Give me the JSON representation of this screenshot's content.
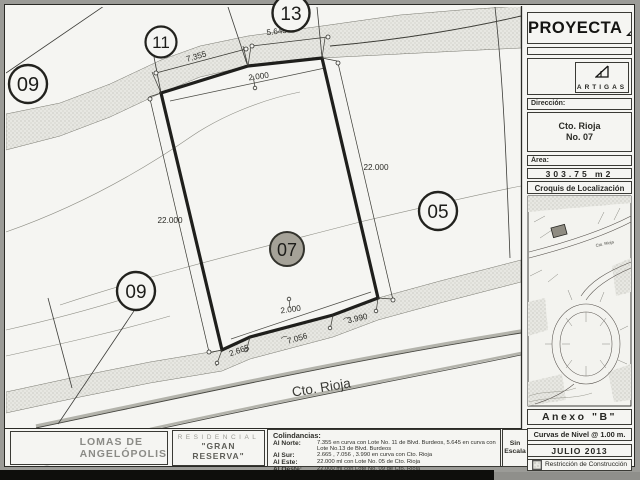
{
  "colors": {
    "paper": "#f5f5f2",
    "ink": "#262622",
    "road_band": "#e7e7e2",
    "subject_lot_fill": "#a5a298",
    "brand_gray": "#8b8b86"
  },
  "header": {
    "proyecta": "PROYECTA",
    "artigas": "ARTIGAS"
  },
  "sidebar": {
    "direccion_label": "Dirección:",
    "direccion_line1": "Cto. Rioja",
    "direccion_line2": "No. 07",
    "area_label": "Área:",
    "area_value": "303.75 m2",
    "croquis_title": "Croquis de Localización",
    "map_street": "Cto. Rioja",
    "anexo": "Anexo \"B\"",
    "curvas": "Curvas de Nivel @ 1.00 m.",
    "fecha": "JULIO 2013",
    "restriccion": "Restricción de Construcción"
  },
  "plan": {
    "street": "Cto. Rioja",
    "lots": {
      "l09a": "09",
      "l11": "11",
      "l13": "13",
      "l05": "05",
      "l09b": "09",
      "l07": "07"
    },
    "dims": {
      "north_left": "7.355",
      "north_right": "5.645",
      "west": "22.000",
      "east": "22.000",
      "south1": "2.665",
      "south2": "7.056",
      "south3": "3.990",
      "setback_top": "2.000",
      "setback_bottom": "2.000"
    },
    "arc": "⌒"
  },
  "footer": {
    "brand_line1": "LOMAS DE",
    "brand_line2": "ANGELÓPOLIS",
    "residencial": "RESIDENCIAL",
    "reserva1": "\"GRAN",
    "reserva2": "RESERVA\"",
    "colindancias_title": "Colindancias:",
    "colindancias": [
      {
        "label": "Al Norte:",
        "value": "7.355 en curva con Lote No. 11 de Blvd. Burdeos, 5.645 en curva con Lote No.13 de Blvd. Burdeos"
      },
      {
        "label": "Al Sur:",
        "value": "2.665 , 7.056 , 3.990 en curva con Cto. Rioja"
      },
      {
        "label": "Al Este:",
        "value": "22.000 ml con Lote No. 05 de Cto. Rioja"
      },
      {
        "label": "Al Oeste:",
        "value": "22.000 ml con Lote No. 09 de Cto. Rioja"
      }
    ],
    "escala1": "Sin",
    "escala2": "Escala"
  }
}
